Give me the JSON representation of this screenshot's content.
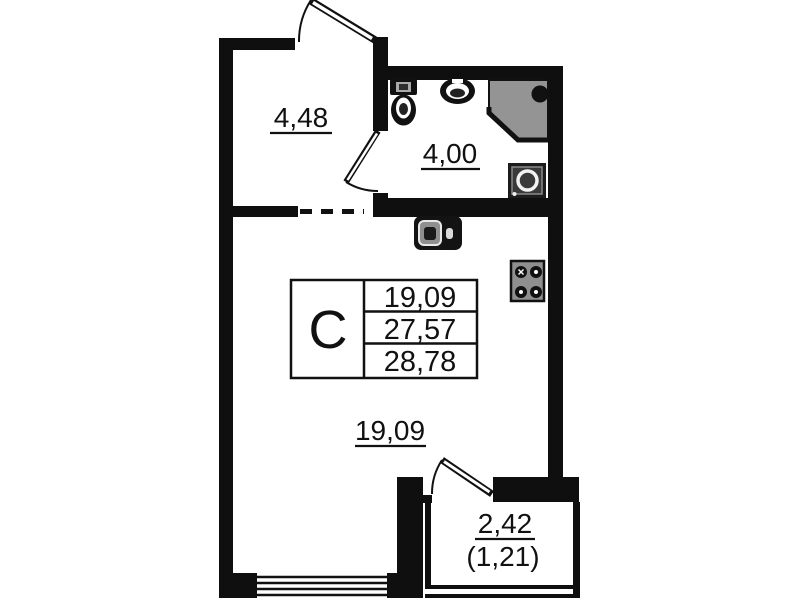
{
  "plan": {
    "type": "apartment-floor-plan",
    "labels": {
      "hallway_area": "4,48",
      "bathroom_area": "4,00",
      "living_area": "19,09",
      "balcony_area": "2,42",
      "balcony_area_reduced": "(1,21)"
    },
    "stamp": {
      "type": "C",
      "living_area": "19,09",
      "total_area": "27,57",
      "total_area_with_balcony": "28,78"
    },
    "fixtures": [
      "toilet",
      "washbasin",
      "shower-cabin",
      "washing-machine",
      "kitchen-sink",
      "stove"
    ],
    "colors": {
      "wall": "#0f0f0f",
      "background": "#ffffff",
      "shower_fill": "#949494",
      "stove_fill": "#8f8f8f"
    }
  }
}
